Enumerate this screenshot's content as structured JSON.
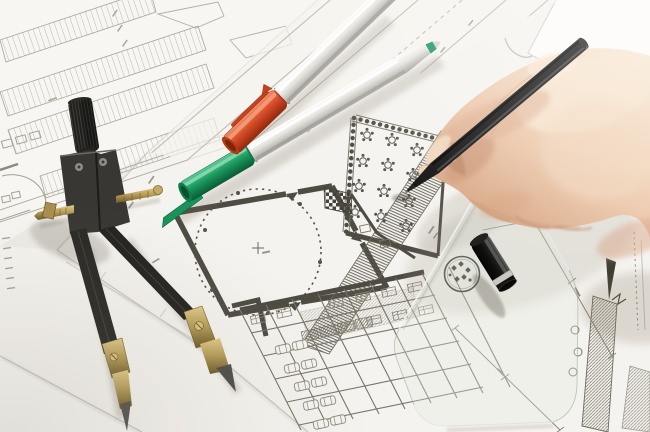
{
  "scene": {
    "aria_label": "Architect workspace photo: right hand drawing on architectural floor plans with a black fineliner pen; drafting compass divider, orange-capped and green-capped pens, black pen cap and a transparent set square with round logo lie on overlapping white blueprint sheets"
  },
  "objects": {
    "hand": "right-hand-holding-pen",
    "black_pen": "black-fineliner-pen",
    "compass": "drafting-compass-divider",
    "pen_orange": "pen-with-orange-cap",
    "pen_green": "pen-with-green-cap",
    "pen_cap_black": "black-pen-cap",
    "set_square": "transparent-set-square-with-logo",
    "floor_plan_main": "floor-plan-round-hall-banquet-room-parking",
    "site_plan": "site-plan-parking-rows",
    "sheets": "overlapping-white-paper-sheets"
  },
  "palette": {
    "paper": "#f3f1ed",
    "paper_bright": "#fbfaf7",
    "paper_shadow": "#d9d6cf",
    "plan_wall": "#4e4b42",
    "plan_ink": "#55524a",
    "plan_line": "#8d897c",
    "plan_light": "#b8b4a8",
    "compass_black": "#2c2b28",
    "brass": "#b39a58",
    "steel": "#cbc9c4",
    "cap_orange": "#d84e2a",
    "cap_green": "#1d9c61",
    "barrel_silver": "#e6e4df",
    "pen_black": "#121212",
    "skin": "#ecc8ab",
    "skin_light": "#f8e6d0",
    "skin_shadow": "#cf9a75",
    "ruler_tint": "#e2e9dd",
    "logo_ink": "#4d5248"
  }
}
